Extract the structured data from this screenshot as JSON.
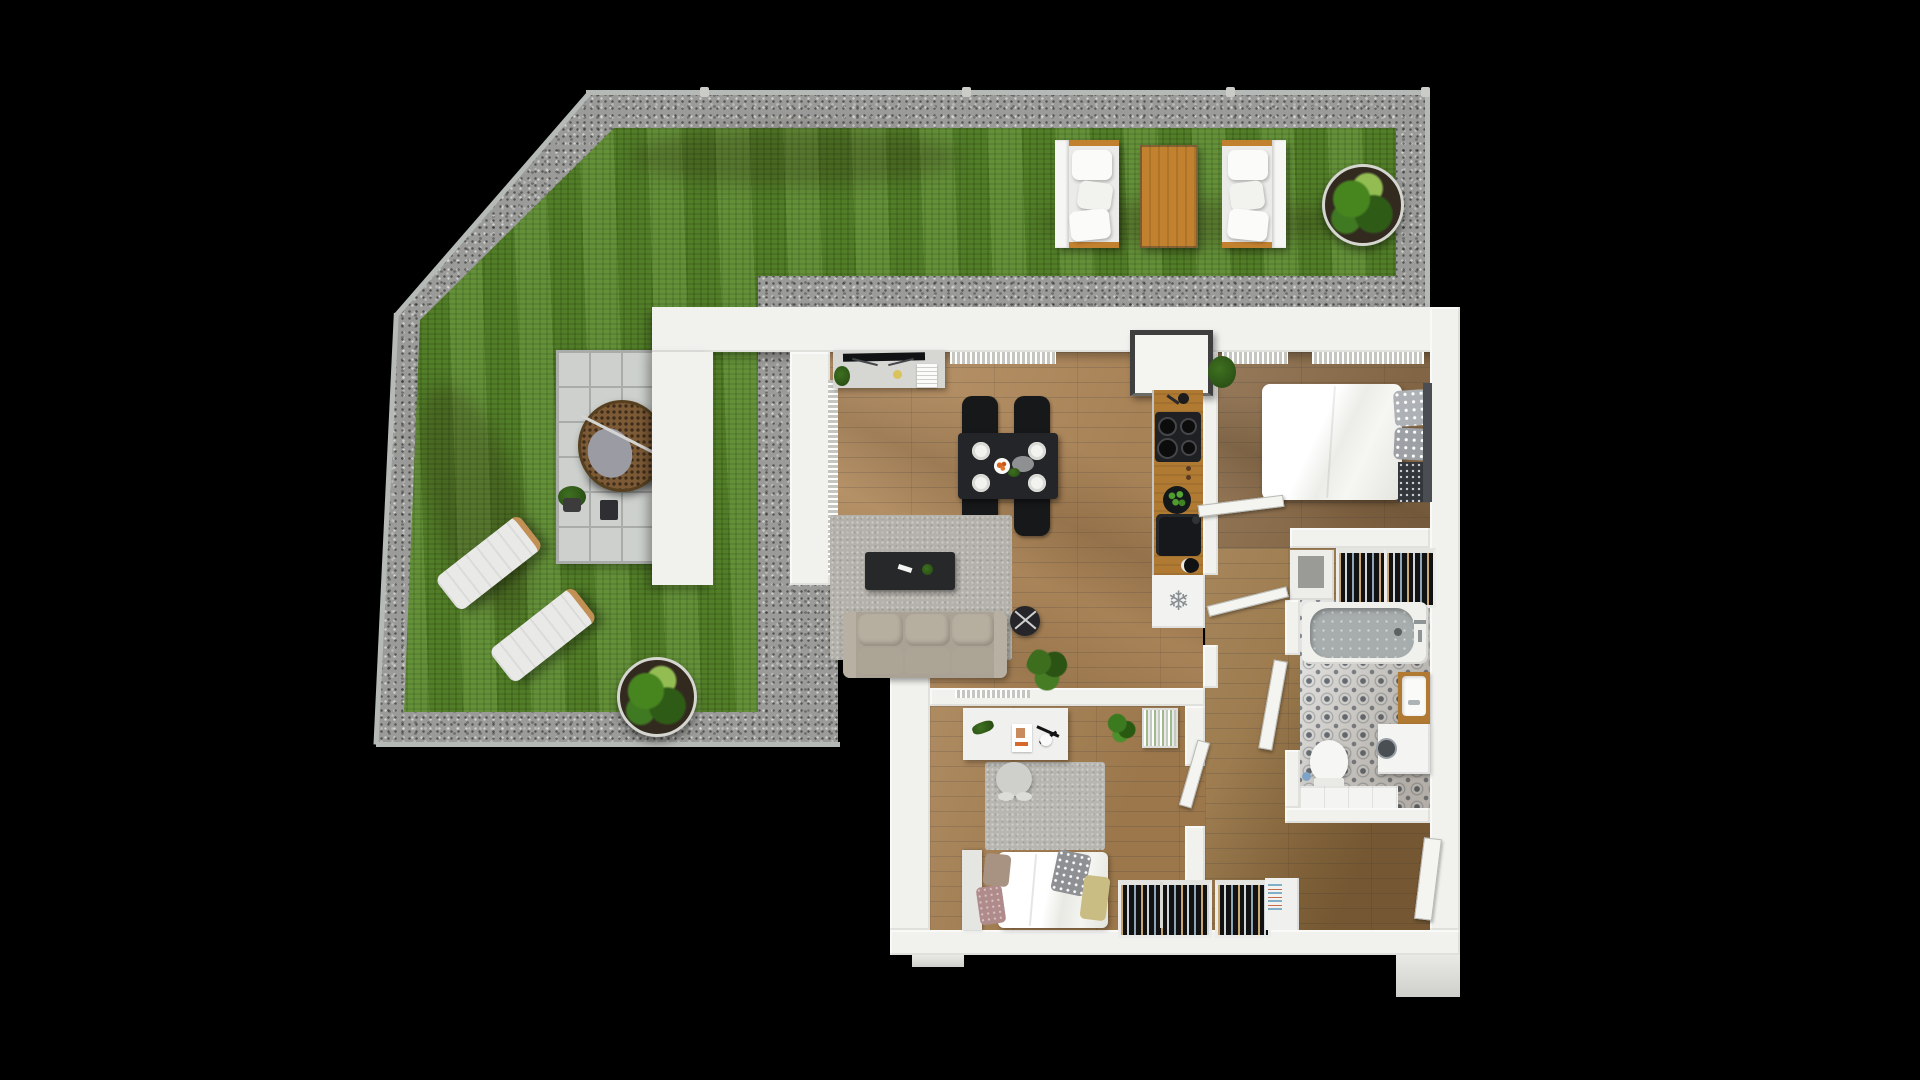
{
  "scene": {
    "type": "3d-floor-plan-render",
    "background": "#000000",
    "description": "Top-down render of a one-bedroom-plus apartment with garden terrace"
  },
  "palette": {
    "grass": "#5a8a2c",
    "gravel": "#9b9b99",
    "wall": "#f1f1ee",
    "patio-tile": "#cdd0cd",
    "wood-living": "#b28a5c",
    "wood-bed1": "#8a6b48",
    "wood-bed2": "#a57e50",
    "wood-hall": "#9c7848",
    "wood-accent": "#b07a33",
    "outdoor-table": "#c2812f",
    "rug": "#b3b1aa",
    "sofa": "#aaa294",
    "black-furniture": "#232528",
    "bed-white": "#f3f3f1",
    "headboard": "#4a4e52",
    "tub-gray": "#a7adad",
    "tile-base": "#e9e9e7",
    "tile-motif": "#6e7680",
    "cushion-gray": "#aeb2b6",
    "lounger": "#e9e9e7"
  },
  "icons": {
    "fridge_snowflake": "❄"
  },
  "garden": {
    "areas": [
      "gravel-border",
      "lawn",
      "patio-tiles"
    ],
    "furniture": [
      "outdoor-sofa",
      "outdoor-table",
      "outdoor-sofa",
      "round-planter",
      "hanging-egg-chair",
      "sun-lounger",
      "sun-lounger",
      "round-planter",
      "potted-plant"
    ]
  },
  "rooms": [
    {
      "name": "living-kitchen",
      "furniture": [
        "tv-sideboard",
        "dining-table",
        "dining-chairs-x4",
        "area-rug",
        "coffee-table",
        "sofa",
        "floor-lamp",
        "plant",
        "kitchen-counter",
        "cooktop",
        "sink",
        "fruit-bowl",
        "fridge"
      ]
    },
    {
      "name": "bedroom-1",
      "furniture": [
        "double-bed",
        "pillows",
        "plant",
        "open-wardrobe",
        "cabinet"
      ]
    },
    {
      "name": "bathroom",
      "furniture": [
        "bathtub",
        "toilet",
        "vanity-sink",
        "washing-machine",
        "tiled-ledge"
      ]
    },
    {
      "name": "bedroom-2",
      "furniture": [
        "desk",
        "desk-chair",
        "desk-lamp",
        "bookshelf",
        "plant",
        "single-bed",
        "pillows",
        "area-rug",
        "open-wardrobe"
      ]
    },
    {
      "name": "hallway",
      "furniture": [
        "open-wardrobe",
        "cabinet",
        "entrance-door"
      ]
    }
  ]
}
